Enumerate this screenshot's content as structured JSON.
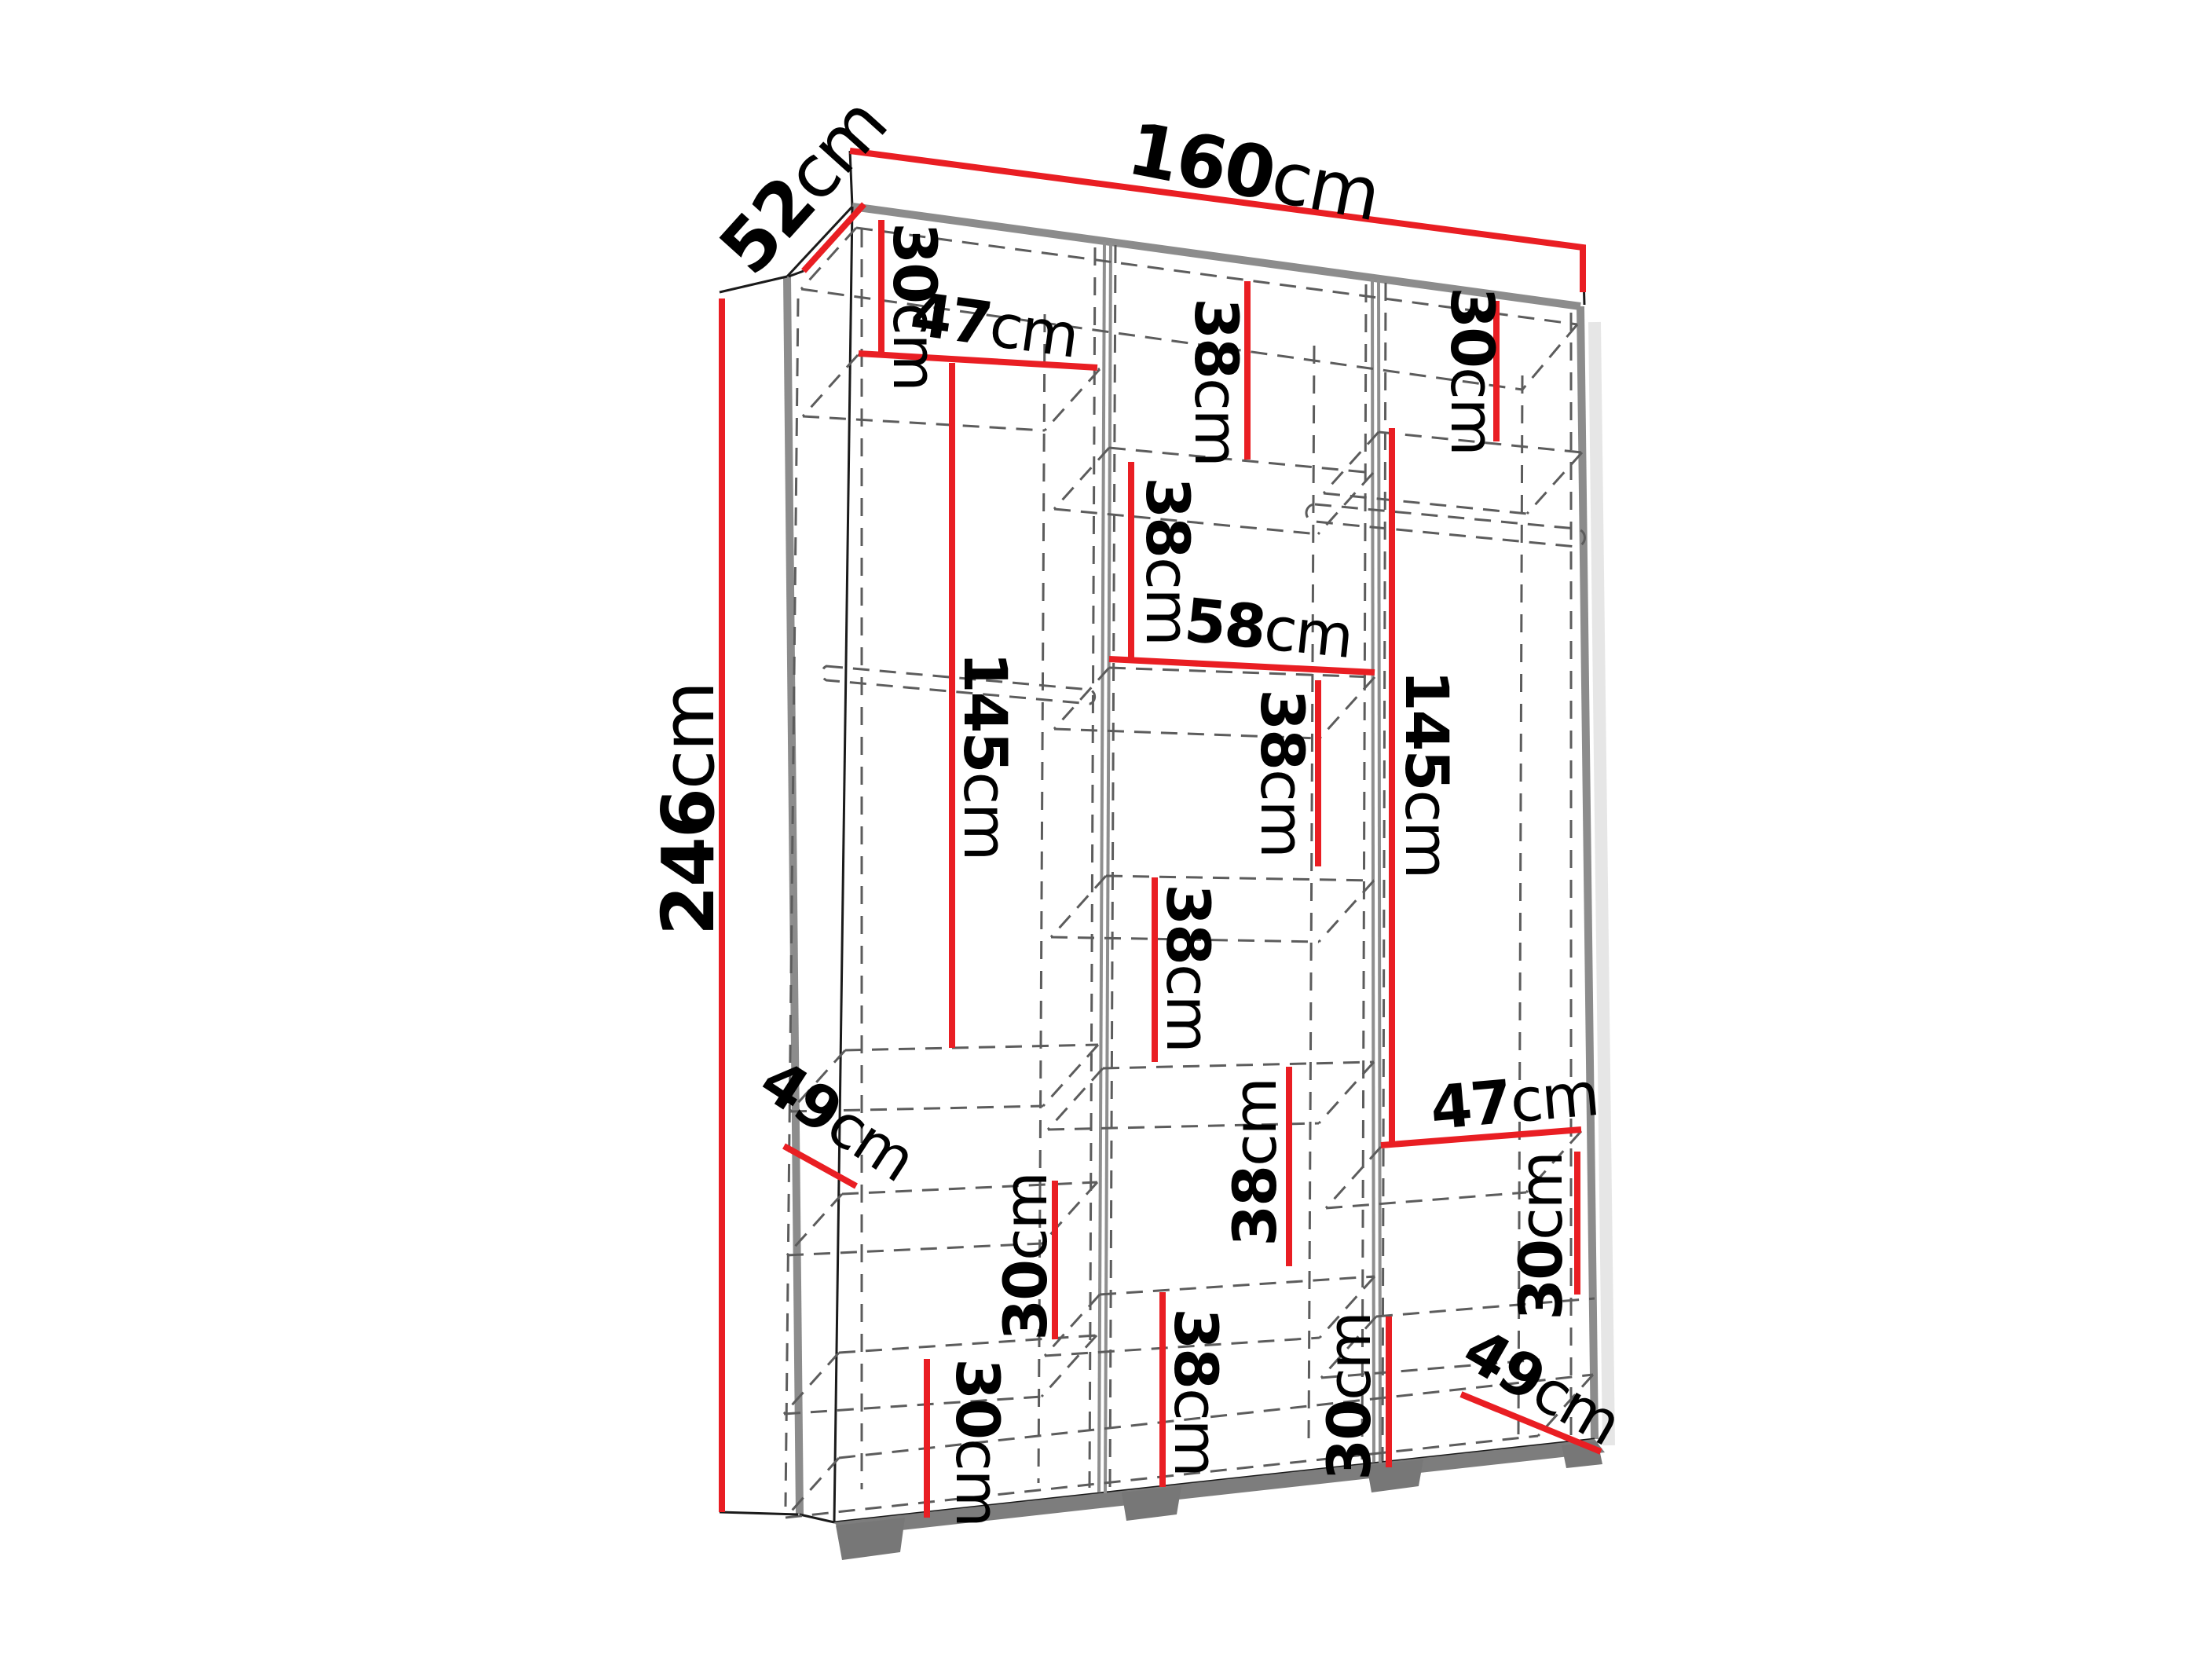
{
  "diagram": {
    "type": "furniture-dimension-drawing",
    "subject": "three-section wardrobe, perspective view with dashed interior shelves",
    "unit": "cm",
    "colors": {
      "dimension_line": "#e91e23",
      "edges": "#8c8c8c",
      "dashes": "#5c5c5c",
      "text": "#000000"
    },
    "overall": {
      "width_cm": "160",
      "depth_cm": "52",
      "height_cm": "246"
    },
    "labels": [
      {
        "id": "overall-width",
        "value": "160",
        "unit": "cm"
      },
      {
        "id": "overall-depth",
        "value": "52",
        "unit": "cm"
      },
      {
        "id": "overall-height",
        "value": "246",
        "unit": "cm"
      },
      {
        "id": "left-top-height",
        "value": "30",
        "unit": "cm"
      },
      {
        "id": "left-shelf-width",
        "value": "47",
        "unit": "cm"
      },
      {
        "id": "left-section-height",
        "value": "145",
        "unit": "cm"
      },
      {
        "id": "left-shelf-depth",
        "value": "49",
        "unit": "cm"
      },
      {
        "id": "left-mid-height",
        "value": "30",
        "unit": "cm"
      },
      {
        "id": "left-bottom-height",
        "value": "30",
        "unit": "cm"
      },
      {
        "id": "middle-gap-1",
        "value": "38",
        "unit": "cm"
      },
      {
        "id": "middle-gap-2",
        "value": "38",
        "unit": "cm"
      },
      {
        "id": "middle-gap-3",
        "value": "38",
        "unit": "cm"
      },
      {
        "id": "middle-shelf-width",
        "value": "58",
        "unit": "cm"
      },
      {
        "id": "middle-gap-4",
        "value": "38",
        "unit": "cm"
      },
      {
        "id": "middle-gap-5",
        "value": "38",
        "unit": "cm"
      },
      {
        "id": "middle-gap-6",
        "value": "38",
        "unit": "cm"
      },
      {
        "id": "right-top-height",
        "value": "30",
        "unit": "cm"
      },
      {
        "id": "right-section-height",
        "value": "145",
        "unit": "cm"
      },
      {
        "id": "right-shelf-width",
        "value": "47",
        "unit": "cm"
      },
      {
        "id": "right-upper-height",
        "value": "30",
        "unit": "cm"
      },
      {
        "id": "right-lower-height",
        "value": "30",
        "unit": "cm"
      },
      {
        "id": "right-shelf-depth",
        "value": "49",
        "unit": "cm"
      }
    ]
  }
}
